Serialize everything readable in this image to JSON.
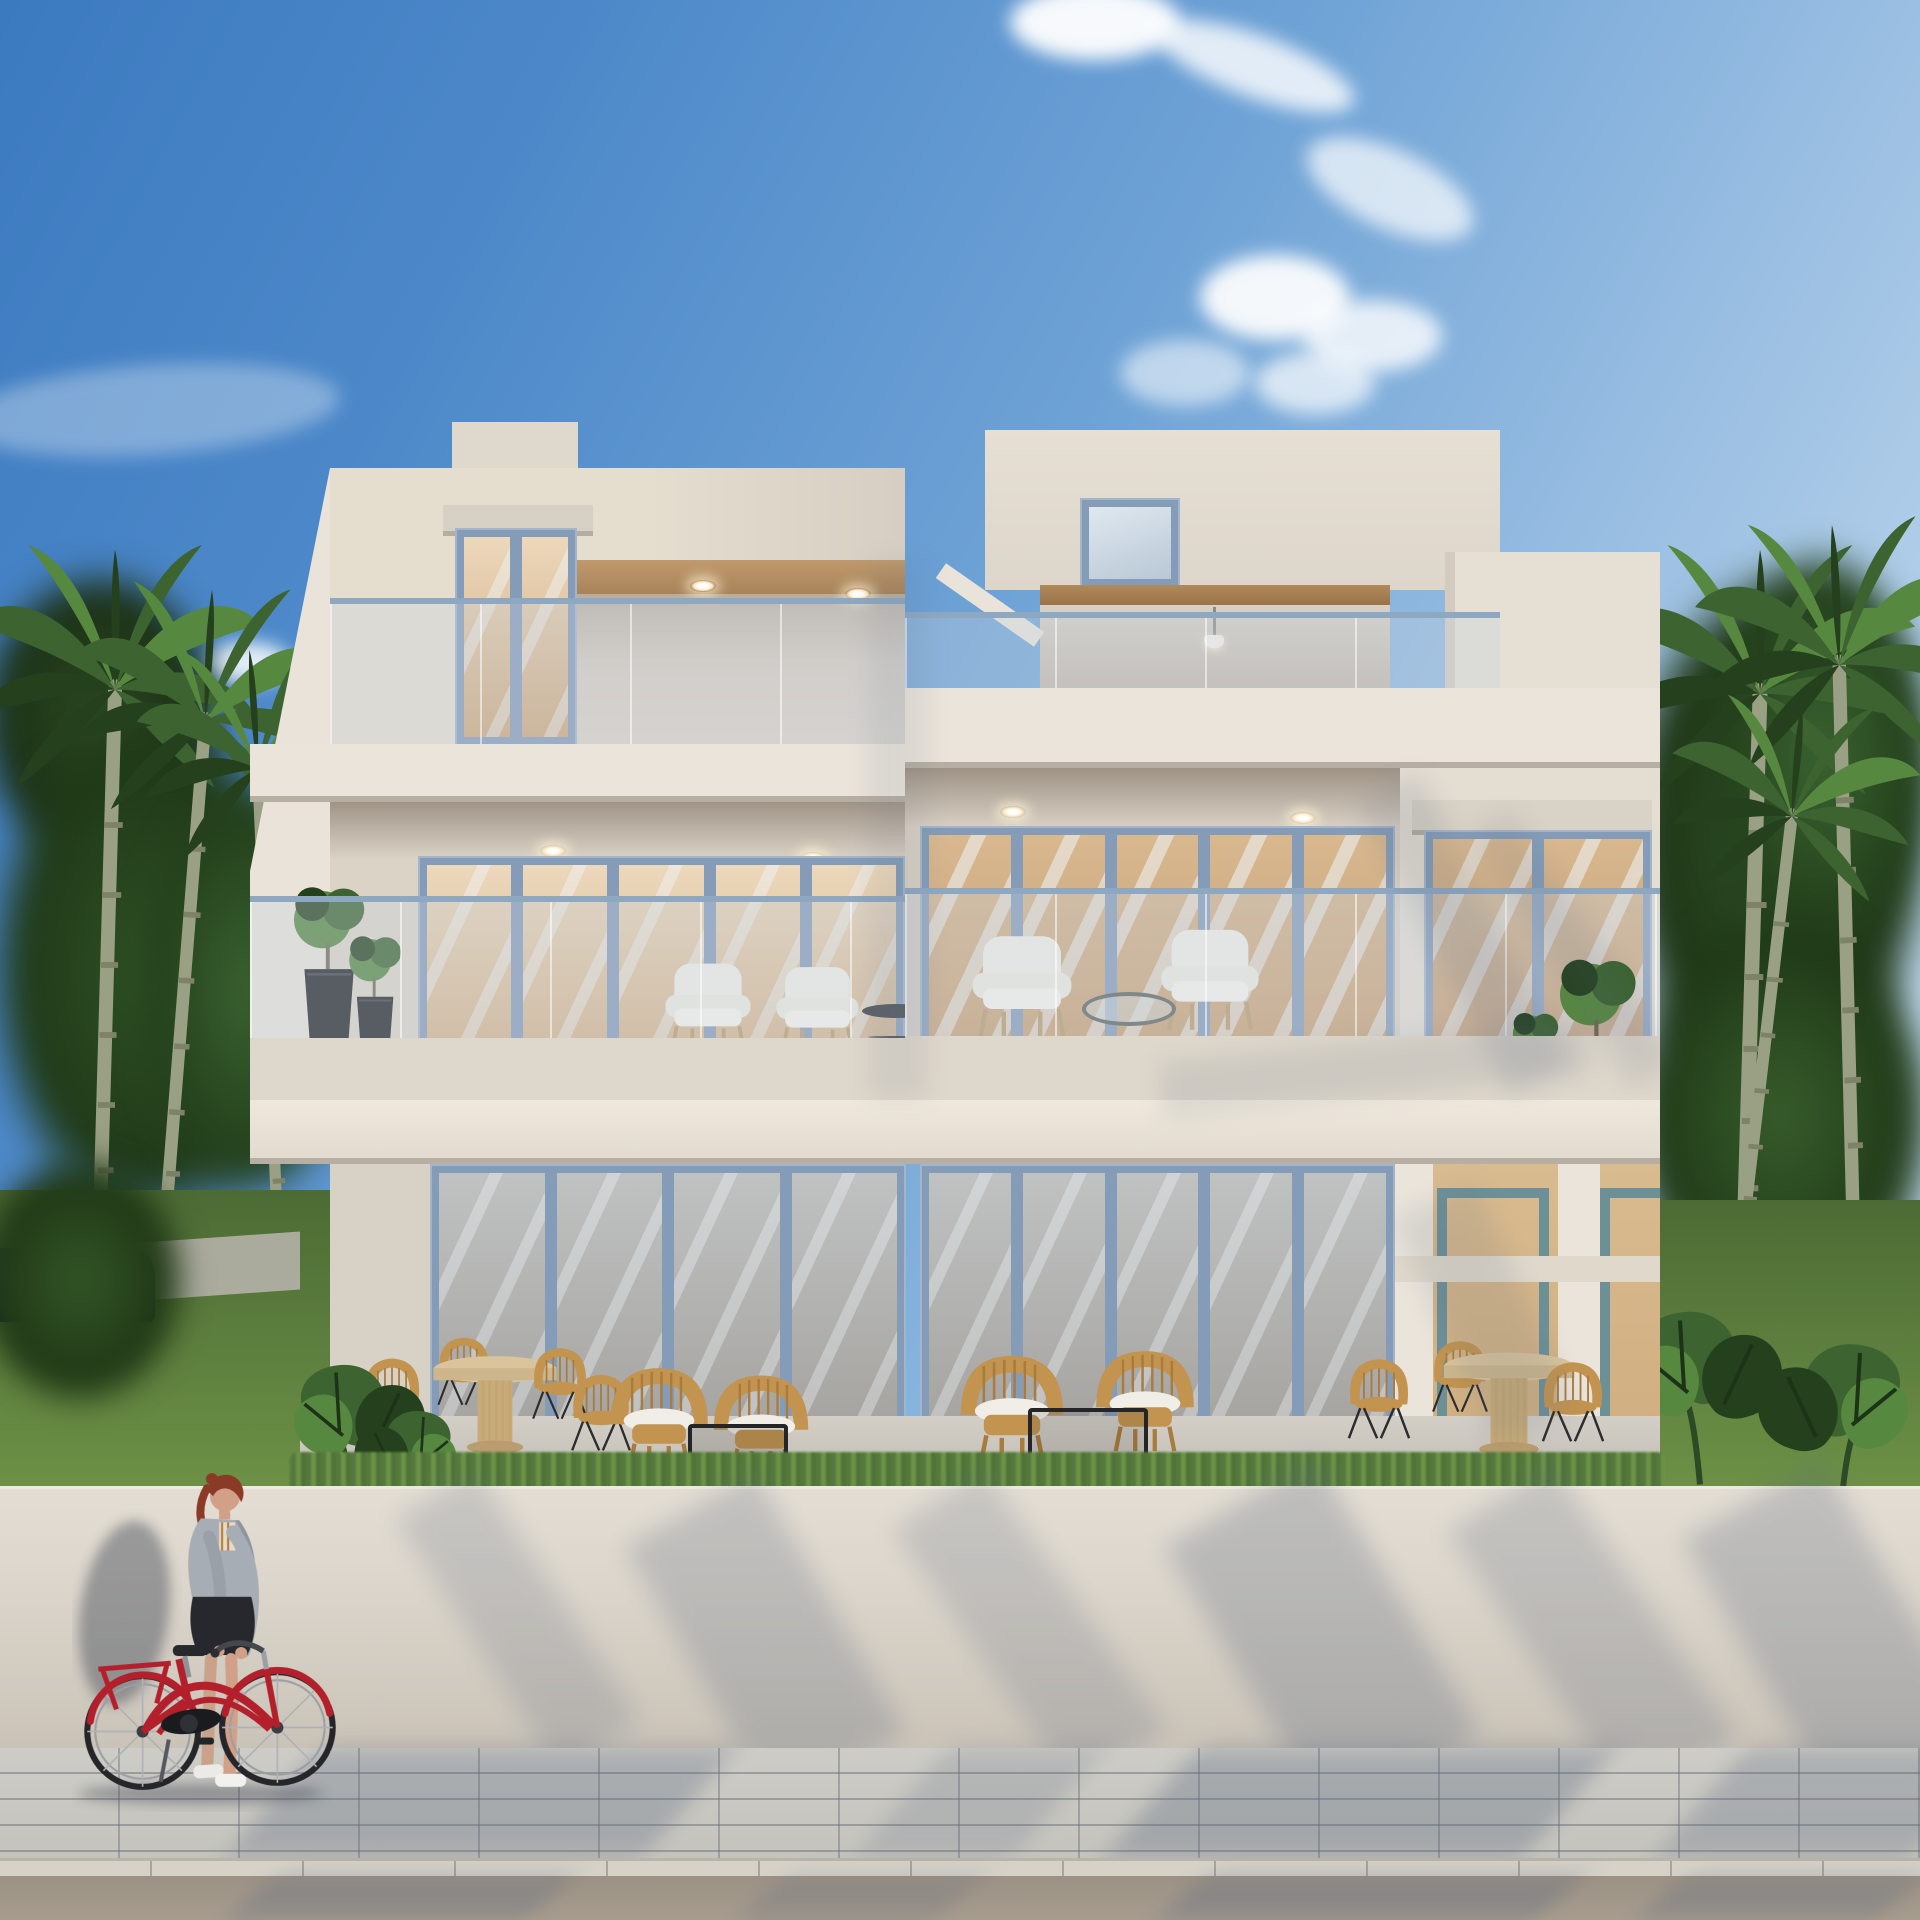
{
  "scene": {
    "type": "architectural-exterior-rendering",
    "subject": "modern three-story duplex villa, cream stucco with stepped flat-roof volumes",
    "setting": "tropical street lined with tall palms and lush greenery under a clear blue sky with scattered clouds",
    "foreground": "low cream boundary wall, paver sidewalk and asphalt road with tree shadows; a red-haired woman walks a red step-through bicycle",
    "lighting": "bright daylight from the right, soft palm-frond shadows on facade, wall and pavement"
  },
  "building": {
    "floors": 3,
    "units": 2,
    "roof_level": [
      "glass-railed roof terraces",
      "tall glazed door on left tower",
      "recessed loggia with pendant light and wood beam"
    ],
    "middle_level": [
      "two deep balconies with glass balustrades",
      "blue-framed sliding glass doors",
      "white lounge armchairs",
      "round coffee tables",
      "potted plants in black planters",
      "window reflecting palms"
    ],
    "ground_level": [
      "full-height folding glass walls",
      "warm lit interiors with kitchens, gold pendant lights and beige sofas",
      "covered terraces with rattan dining sets and rattan lounge chairs",
      "open porch bay at right"
    ]
  },
  "street": {
    "woman": "red ponytail, gray-blue jacket, dark skirt, white sneakers, pushing bicycle",
    "bicycle": "red classic step-through frame with rear rack and fenders",
    "car": "dark car parked behind greenery at far left",
    "surfaces": [
      "boundary wall",
      "herringbone paver sidewalk",
      "stone curb",
      "asphalt road"
    ]
  },
  "palette": {
    "sky-deep": "#3c7ac0",
    "sky-mid": "#6fa3d6",
    "sky-pale": "#cfe2f2",
    "cream": "#dfd8cd",
    "cream-light": "#eae4da",
    "cream-dark": "#cdc5b9",
    "cream-shade": "#b7afa3",
    "tan-ceiling": "#c09a6c",
    "tan-deep": "#a8835a",
    "frame-blue": "#849cb8",
    "rail-blue": "#8ea8c2",
    "glass-warm1": "#ecd8bc",
    "glass-warm2": "#cfa87c",
    "glass-tan": "#c59a6f",
    "interior-warm": "#e2c298",
    "cabinet": "#f0e9db",
    "gold": "#c9a44c",
    "green-dark": "#24401d",
    "green-mid": "#3c6330",
    "green-light": "#578840",
    "trunk": "#99a083",
    "lawn1": "#4c6b35",
    "lawn2": "#6d9146",
    "rattan": "#c2944f",
    "rattan-dark": "#a87b3e",
    "cushion": "#f1eee7",
    "wood": "#d9c49c",
    "black-metal": "#232528",
    "wall-front": "#dcd6cc",
    "pave": "#c5c3bd",
    "curb": "#d6d2c8",
    "road": "#a79c8e",
    "shadow-blue": "#5c6a80",
    "bike-red": "#b3202b",
    "skin": "#d2a088",
    "hair": "#8a3a26",
    "jacket": "#a7adb4",
    "skirt": "#26282e",
    "pot": "#1f2125",
    "sofa": "#cdb695",
    "teal": "#4f7672",
    "car": "#1f2a38"
  }
}
